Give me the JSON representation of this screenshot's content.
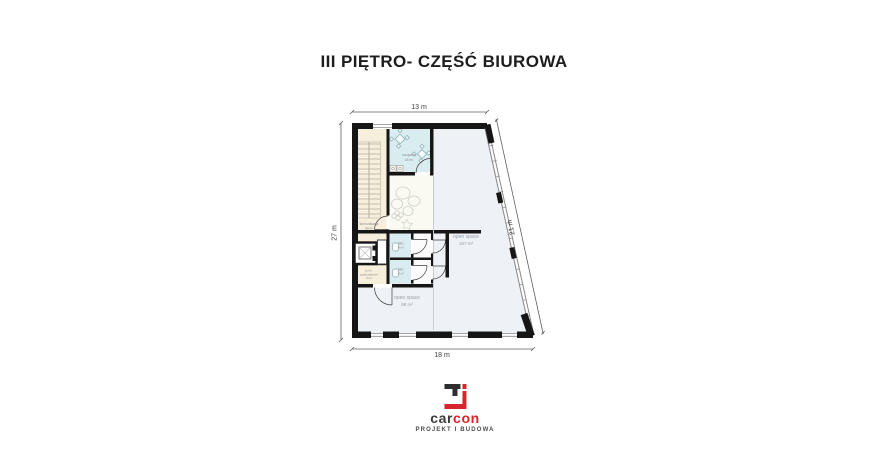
{
  "title": "III PIĘTRO- CZĘŚĆ BIUROWA",
  "dimensions": {
    "top": "13 m",
    "left": "27 m",
    "right": "21 m",
    "bottom": "18 m"
  },
  "rooms": {
    "socjalna": {
      "name": "socjalna",
      "area": "18 m²"
    },
    "komunikacja": {
      "name": "komunikacja",
      "area": "30 m²"
    },
    "wc_upper": {
      "name": "WC",
      "area": "4 m²"
    },
    "wc_lower": {
      "name": "WC",
      "area": "4 m²"
    },
    "gospodarcze": {
      "name_line1": "pom.",
      "name_line2": "gospodarcze",
      "area": "3 m²"
    },
    "open_space_main": {
      "name": "open space",
      "area": "187 m²"
    },
    "open_space_lower": {
      "name": "open space",
      "area": "98 m²"
    }
  },
  "logo": {
    "brand_dark": "car",
    "brand_red": "con",
    "tagline": "PROJEKT I BUDOWA"
  },
  "colors": {
    "accent_red": "#d6252b",
    "wall_black": "#161616",
    "room_blue": "#d9ecef",
    "room_cream": "#f5efdc",
    "open_space_fill": "#eef1f6"
  }
}
